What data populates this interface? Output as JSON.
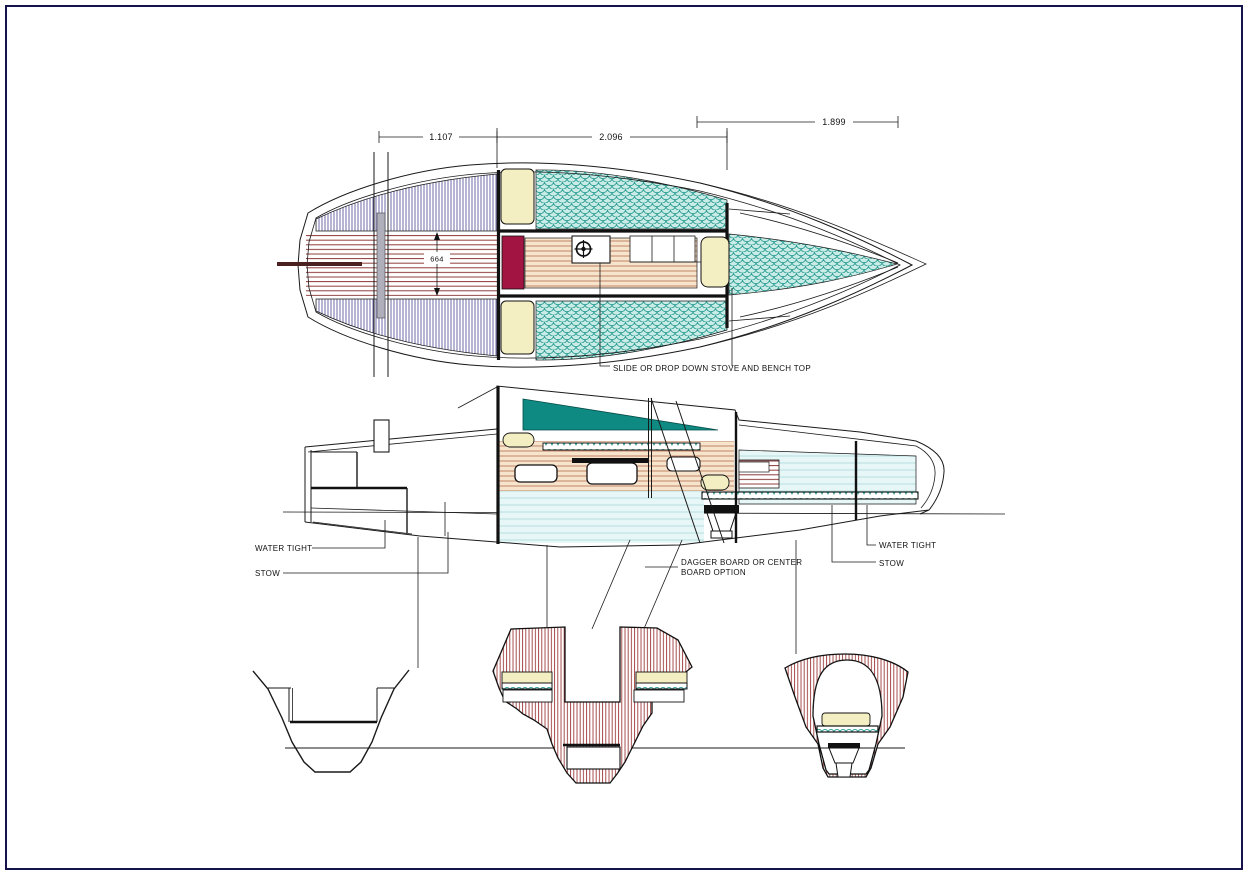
{
  "sheet": {
    "background": "#FFFFFF",
    "border_color": "#14144B"
  },
  "dims": {
    "dim_left": "1.107",
    "dim_mid": "2.096",
    "dim_right": "1.899",
    "beam": "664"
  },
  "labels": {
    "stove_note": "SLIDE OR DROP DOWN STOVE AND BENCH TOP",
    "water_tight_left": "WATER TIGHT",
    "stow_left": "STOW",
    "water_tight_right": "WATER TIGHT",
    "stow_right": "STOW",
    "dagger_note_line1": "DAGGER BOARD OR CENTER",
    "dagger_note_line2": "BOARD OPTION"
  },
  "colors": {
    "border_navy": "#14144B",
    "outline_black": "#1A1A1A",
    "crimson_locker": "#A21441",
    "cream": "#F4EEC3",
    "teal_window": "#0E8A82",
    "scale_teal": "#2F9E94",
    "scale_bg": "#C9ECE7",
    "hatch_red": "#9C3A38",
    "hatch_blue": "#5B5B9E",
    "stripe_red": "#8F3B3B",
    "tan_bg": "#F7E4CC",
    "tan_line": "#BC7A5E",
    "cyan_bg": "#E7F6F6",
    "cyan_line": "#ABDADA",
    "traveler_gray": "#AFAFBC",
    "tiller_brown": "#4A2020",
    "fixture_dark": "#111111"
  }
}
